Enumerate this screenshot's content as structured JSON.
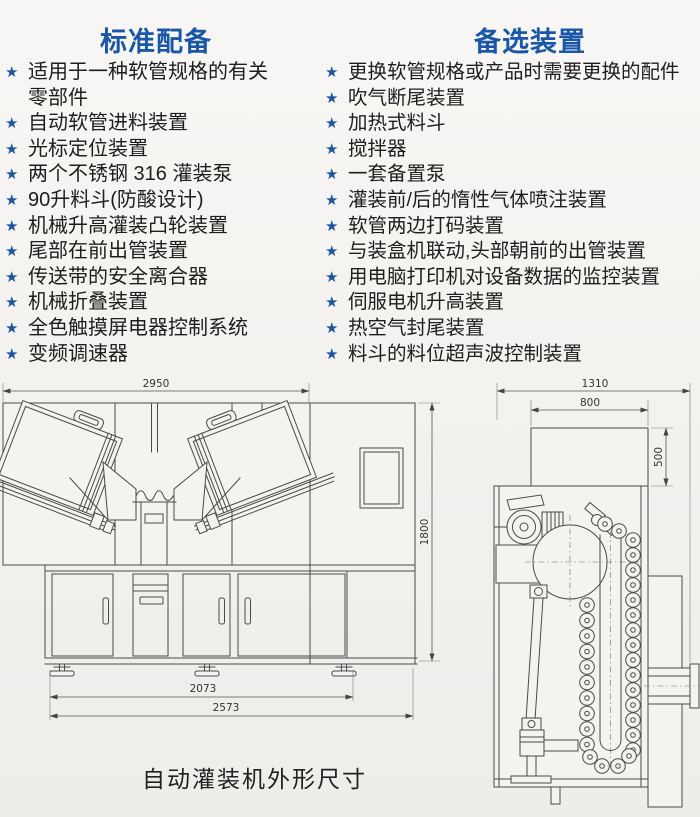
{
  "bullet": {
    "glyph": "★",
    "color": "#1d55a3"
  },
  "accent_color": "#1a57a8",
  "columns": {
    "standard": {
      "title": "标准配备",
      "items": [
        "适用于一种软管规格的有关零部件",
        "自动软管进料装置",
        "光标定位装置",
        "两个不锈钢 316 灌装泵",
        "90升料斗(防酸设计)",
        "机械升高灌装凸轮装置",
        "尾部在前出管装置",
        "传送带的安全离合器",
        "机械折叠装置",
        "全色触摸屏电器控制系统",
        "变频调速器"
      ]
    },
    "optional": {
      "title": "备选装置",
      "items": [
        "更换软管规格或产品时需要更换的配件",
        "吹气断尾装置",
        "加热式料斗",
        "搅拌器",
        "一套备置泵",
        "灌装前/后的惰性气体喷注装置",
        "软管两边打码装置",
        "与装盒机联动,头部朝前的出管装置",
        "用电脑打印机对设备数据的监控装置",
        "伺服电机升高装置",
        "热空气封尾装置",
        "料斗的料位超声波控制装置"
      ]
    }
  },
  "diagram": {
    "caption": "自动灌装机外形尺寸",
    "front_view": {
      "width_top": "2950",
      "height": "1800",
      "width_inner": "2073",
      "width_overall": "2573"
    },
    "top_view": {
      "width_overall": "1310",
      "hopper_width": "800",
      "hopper_depth": "500"
    }
  }
}
